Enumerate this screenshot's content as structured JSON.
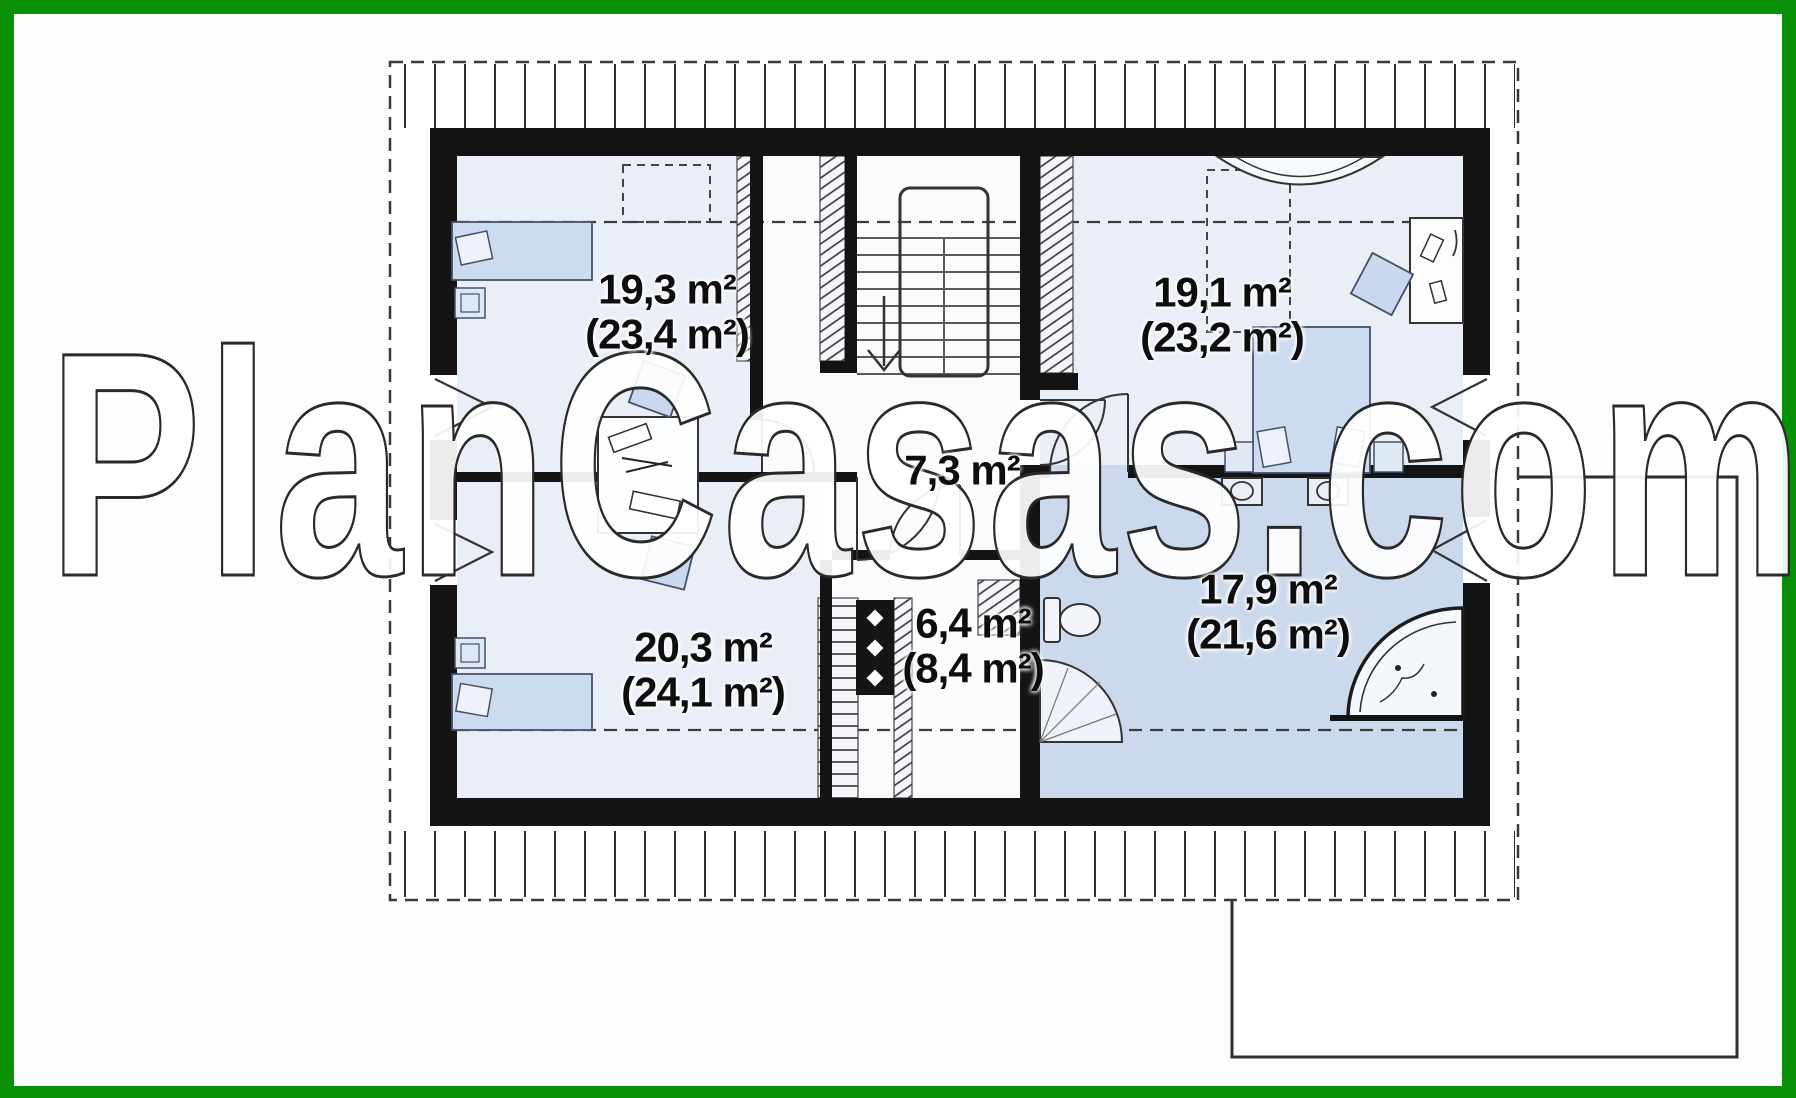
{
  "watermark": "PlanCasas.com",
  "rooms": {
    "top_left": {
      "area": "19,3 m²",
      "gross": "(23,4 m²)"
    },
    "top_right": {
      "area": "19,1 m²",
      "gross": "(23,2 m²)"
    },
    "hall": {
      "area": "7,3 m²",
      "gross": ""
    },
    "bottom_left": {
      "area": "20,3 m²",
      "gross": "(24,1 m²)"
    },
    "wardrobe": {
      "area": "6,4 m²",
      "gross": "(8,4 m²)"
    },
    "bathroom": {
      "area": "17,9 m²",
      "gross": "(21,6 m²)"
    }
  },
  "colors": {
    "border_green": "#0a9008",
    "wall_black": "#141414",
    "room_fill": "#e9eef7",
    "bathroom_fill": "#cbd9ec",
    "furniture_fill": "#ccdcf0"
  }
}
